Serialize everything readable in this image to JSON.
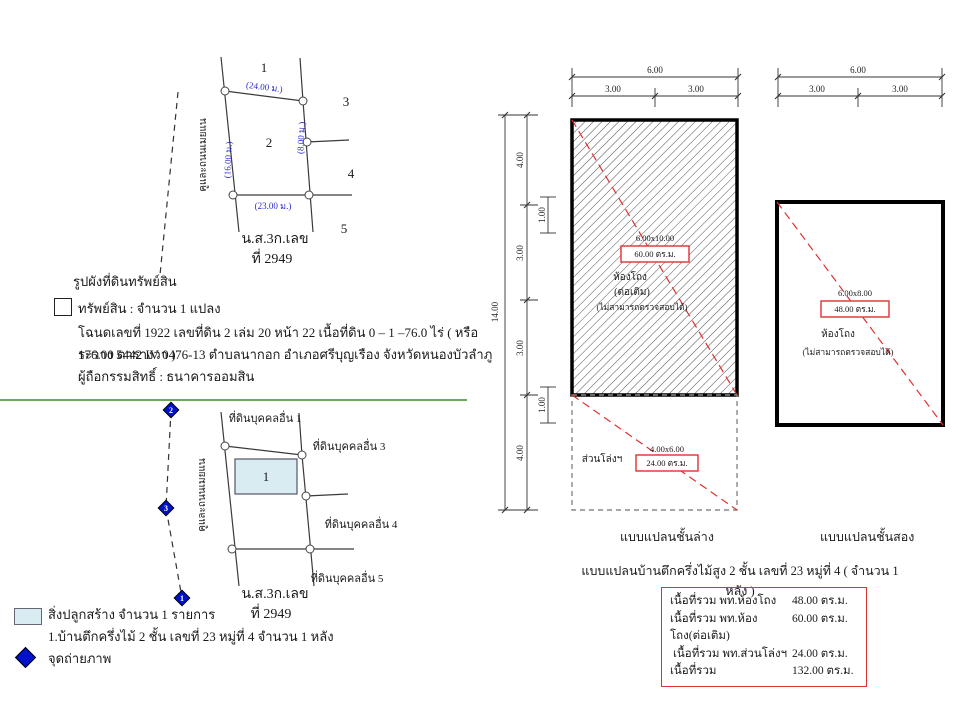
{
  "colors": {
    "dimension_blue": "#2b2bd0",
    "highlight_red": "#e03131",
    "building_fill": "#d9ecf2",
    "divider_green": "#6ca85c",
    "photo_point_blue": "#0011cc"
  },
  "plot_sketch": {
    "road_label": "คูและถนนเมยแน",
    "dim_top": "(24.00 ม.)",
    "dim_bottom": "(23.00 ม.)",
    "dim_left": "(16.00 ม.)",
    "dim_right": "(8.00 ม.)",
    "parcel_labels": [
      "1",
      "2",
      "3",
      "4",
      "5"
    ],
    "deed_line1": "น.ส.3ก.เลข",
    "deed_line2": "ที่ 2949"
  },
  "property_info": {
    "heading": "รูปผังที่ดินทรัพย์สิน",
    "line1": "ทรัพย์สิน : จำนวน 1 แปลง",
    "line2": "โฉนดเลขที่ 1922 เลขที่ดิน 2  เล่ม 20 หน้า 22 เนื้อที่ดิน 0 – 1 –76.0 ไร่ ( หรือ 176.00 ตารางวา )",
    "line3": "ระวาง 5442 IV 0476-13  ตำบลนากอก อำเภอศรีบุญเรือง จังหวัดหนองบัวลำภู",
    "line4": "ผู้ถือกรรมสิทธิ์ : ธนาคารออมสิน"
  },
  "building_sketch": {
    "road_label": "คูและถนนเมยแน",
    "neighbor1": "ที่ดินบุคคลอื่น 1",
    "neighbor3": "ที่ดินบุคคลอื่น 3",
    "neighbor4": "ที่ดินบุคคลอื่น 4",
    "neighbor5": "ที่ดินบุคคลอื่น 5",
    "building_no": "1",
    "photo_point_top": "2",
    "photo_point_mid": "3",
    "photo_point_bottom": "1",
    "deed_line1": "น.ส.3ก.เลข",
    "deed_line2": "ที่ 2949"
  },
  "legend": {
    "building_label": "สิ่งปลูกสร้าง จำนวน 1 รายการ",
    "building_detail": "1.บ้านตึกครึ่งไม้ 2 ชั้น เลขที่ 23 หมู่ที่ 4 จำนวน 1 หลัง",
    "photo_label": "จุดถ่ายภาพ"
  },
  "ground_plan": {
    "title": "แบบแปลนชั้นล่าง",
    "dim_top_total": "6.00",
    "dim_top_left": "3.00",
    "dim_top_right": "3.00",
    "dim_left_total": "14.00",
    "dim_left_seg1": "4.00",
    "dim_left_seg2": "3.00",
    "dim_left_seg3": "3.00",
    "dim_left_seg4": "4.00",
    "dim_inner_top": "1.00",
    "dim_inner_bottom": "1.00",
    "room_size": "6.00x10.00",
    "room_area": "60.00 ตร.ม.",
    "room_name": "ห้องโถง",
    "room_note1": "(ต่อเติม)",
    "room_note2": "(ไม่สามารถตรวจสอบได้)",
    "open_label": "ส่วนโล่งฯ",
    "open_size": "4.00x6.00",
    "open_area": "24.00 ตร.ม."
  },
  "second_plan": {
    "title": "แบบแปลนชั้นสอง",
    "dim_top_total": "6.00",
    "dim_top_left": "3.00",
    "dim_top_right": "3.00",
    "room_size": "6.00x8.00",
    "room_area": "48.00 ตร.ม.",
    "room_name": "ห้องโถง",
    "room_note": "(ไม่สามารถตรวจสอบได้)"
  },
  "plans_caption": "แบบแปลนบ้านตึกครึ่งไม้สูง 2 ชั้น เลขที่ 23 หมู่ที่ 4  ( จำนวน 1 หลัง )",
  "area_summary": {
    "rows": [
      {
        "label": "เนื้อที่รวม พท.ห้องโถง",
        "value": "48.00 ตร.ม."
      },
      {
        "label": "เนื้อที่รวม พท.ห้องโถง(ต่อเติม)",
        "value": "60.00 ตร.ม."
      },
      {
        "label": "เนื้อที่รวม พท.ส่วนโล่งฯ",
        "value": "24.00 ตร.ม."
      },
      {
        "label": "เนื้อที่รวม",
        "value": "132.00 ตร.ม."
      }
    ]
  }
}
